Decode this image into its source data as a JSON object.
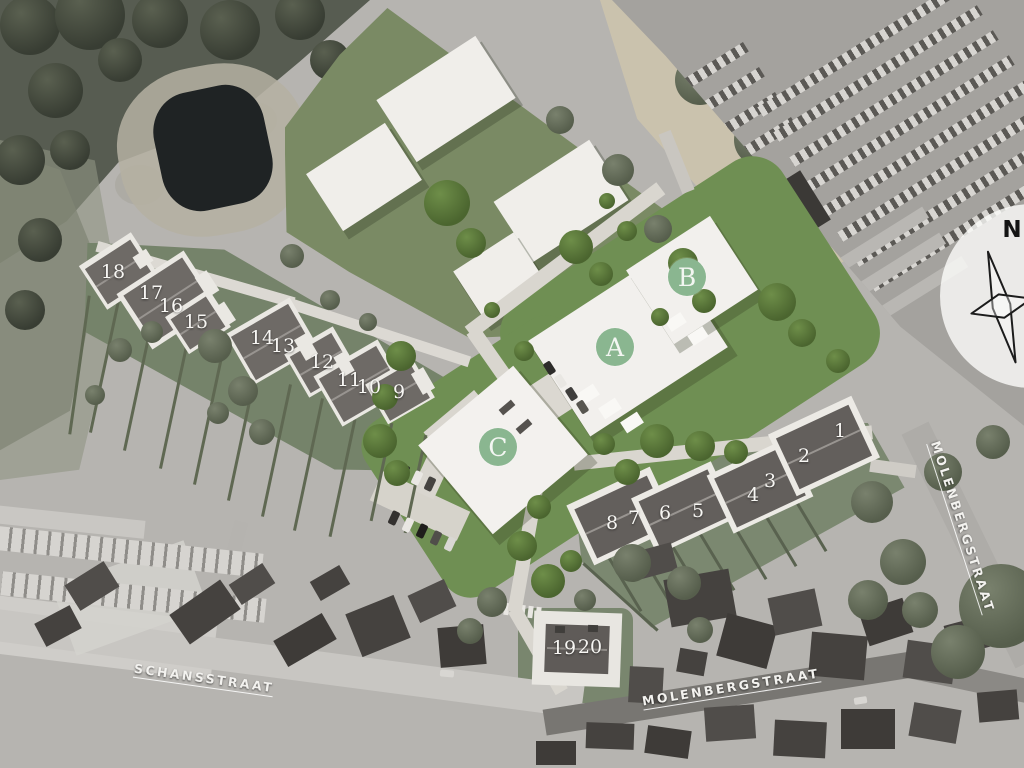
{
  "compass": {
    "label": "N"
  },
  "badges": [
    {
      "label": "A",
      "x": 615,
      "y": 347
    },
    {
      "label": "B",
      "x": 687,
      "y": 277
    },
    {
      "label": "C",
      "x": 498,
      "y": 447
    }
  ],
  "lots": [
    {
      "label": "1",
      "x": 840,
      "y": 431
    },
    {
      "label": "2",
      "x": 804,
      "y": 456
    },
    {
      "label": "3",
      "x": 770,
      "y": 481
    },
    {
      "label": "4",
      "x": 753,
      "y": 495
    },
    {
      "label": "5",
      "x": 698,
      "y": 511
    },
    {
      "label": "6",
      "x": 665,
      "y": 513
    },
    {
      "label": "7",
      "x": 634,
      "y": 518
    },
    {
      "label": "8",
      "x": 612,
      "y": 523
    },
    {
      "label": "9",
      "x": 399,
      "y": 392
    },
    {
      "label": "10",
      "x": 369,
      "y": 387
    },
    {
      "label": "11",
      "x": 349,
      "y": 380
    },
    {
      "label": "12",
      "x": 322,
      "y": 362
    },
    {
      "label": "13",
      "x": 283,
      "y": 346
    },
    {
      "label": "14",
      "x": 262,
      "y": 338
    },
    {
      "label": "15",
      "x": 196,
      "y": 322
    },
    {
      "label": "16",
      "x": 171,
      "y": 306
    },
    {
      "label": "17",
      "x": 151,
      "y": 293
    },
    {
      "label": "18",
      "x": 113,
      "y": 272
    },
    {
      "label": "19",
      "x": 564,
      "y": 648
    },
    {
      "label": "20",
      "x": 590,
      "y": 647
    }
  ],
  "streets": [
    {
      "name": "SCHANSSTRAAT",
      "x": 204,
      "y": 679,
      "rotation": 8
    },
    {
      "name": "MOLENBERGSTRAAT",
      "x": 731,
      "y": 688,
      "rotation": -9
    },
    {
      "name": "MOLENBERGSTRAAT",
      "x": 962,
      "y": 527,
      "rotation": 72
    }
  ],
  "colors": {
    "badge_green": "#8ab690",
    "development_grass": "#6f8f53",
    "field_grass": "#7a8a64",
    "building_white": "#f2f0ed",
    "roof_dark": "#6b6763",
    "road_light": "#d9d6cf",
    "pond": "#1f2324"
  }
}
